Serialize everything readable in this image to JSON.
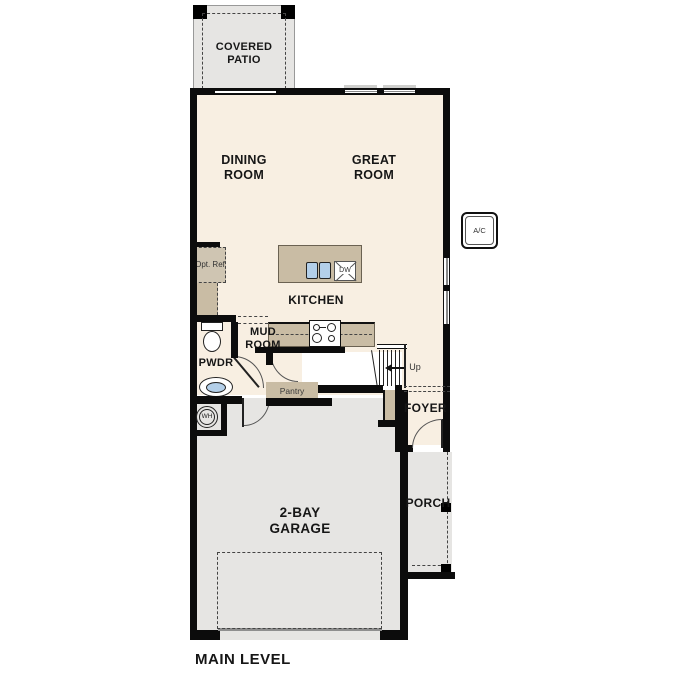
{
  "title": "MAIN LEVEL",
  "rooms": {
    "covered_patio": "COVERED PATIO",
    "dining_room": "DINING ROOM",
    "great_room": "GREAT ROOM",
    "kitchen": "KITCHEN",
    "mud_room": "MUD ROOM",
    "powder_room": "PWDR",
    "pantry": "Pantry",
    "foyer": "FOYER",
    "porch": "PORCH",
    "garage": "2-BAY GARAGE"
  },
  "labels": {
    "opt_ref": "Opt. Ref",
    "dishwasher": "DW",
    "water_heater": "WH",
    "ac_unit": "A/C",
    "stairs_up": "Up"
  },
  "colors": {
    "floor_cream": "#f8efe2",
    "cabinet_tan": "#c9bca4",
    "exterior_grey": "#e6e5e3",
    "fixture_blue": "#b3cfe9",
    "wall_black": "#0c0c0c"
  }
}
